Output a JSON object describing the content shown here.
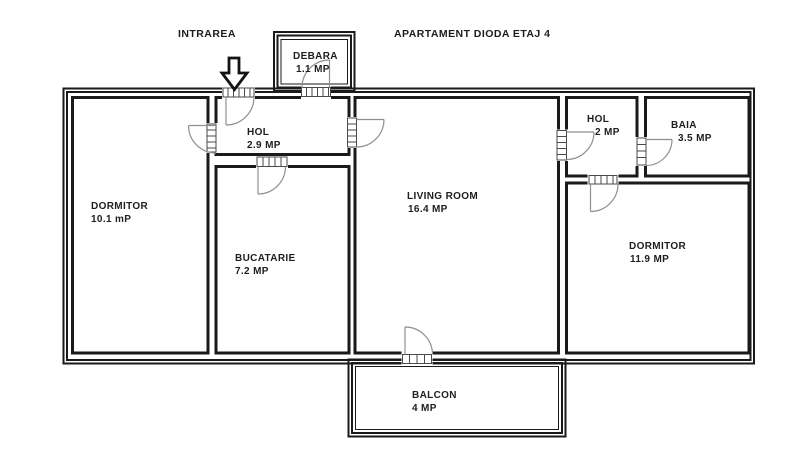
{
  "header": {
    "entrance_label": "INTRAREA",
    "title": "APARTAMENT DIODA ETAJ 4"
  },
  "rooms": {
    "debara": {
      "name": "DEBARA",
      "area": "1.1 MP"
    },
    "hol_entry": {
      "name": "HOL",
      "area": "2.9 MP"
    },
    "dormitor_left": {
      "name": "DORMITOR",
      "area": "10.1 mP"
    },
    "bucatarie": {
      "name": "BUCATARIE",
      "area": "7.2 MP"
    },
    "living": {
      "name": "LIVING ROOM",
      "area": "16.4 MP"
    },
    "hol_right": {
      "name": "HOL",
      "area": "2 MP"
    },
    "baia": {
      "name": "BAIA",
      "area": "3.5 MP"
    },
    "dormitor_right": {
      "name": "DORMITOR",
      "area": "11.9 MP"
    },
    "balcon": {
      "name": "BALCON",
      "area": "4 MP"
    }
  },
  "colors": {
    "wall": "#1a1a1a",
    "door_arc": "#8f8f8f",
    "background": "#ffffff",
    "text": "#1e1e1e"
  }
}
